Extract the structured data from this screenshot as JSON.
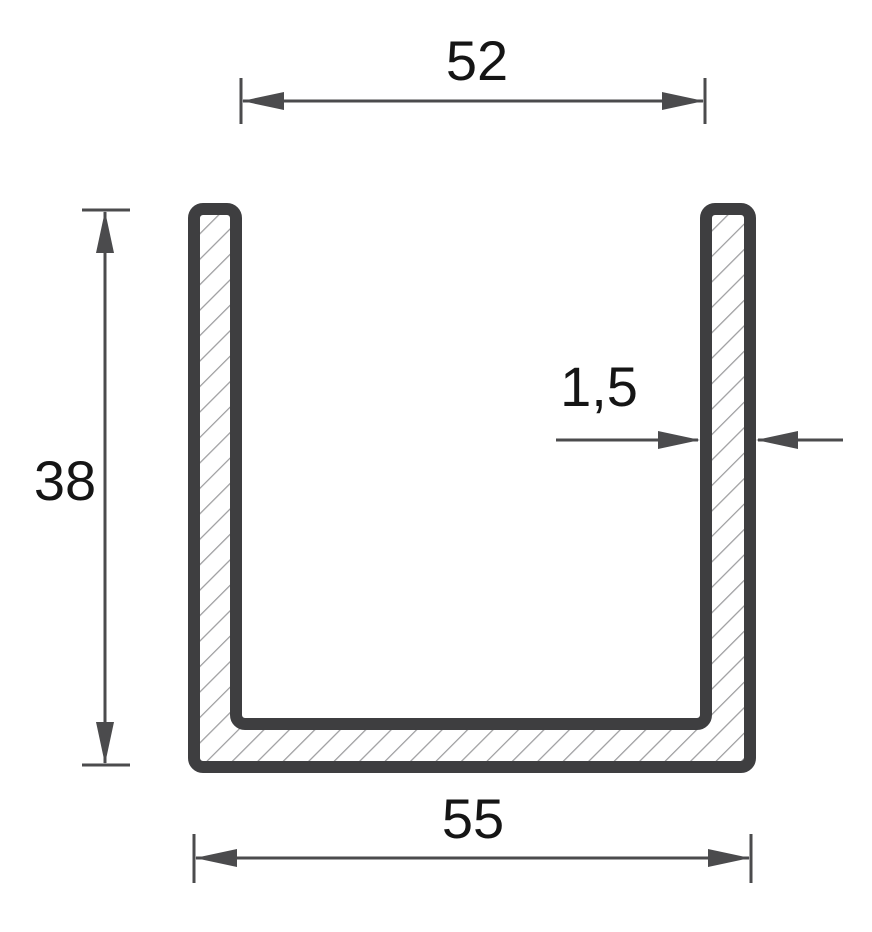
{
  "drawing": {
    "figure": "u-channel-profile-cross-section",
    "dimensions": {
      "inner_width": "52",
      "height": "38",
      "wall_thickness": "1,5",
      "outer_width": "55"
    },
    "colors": {
      "outline": "#3e3e40",
      "dimension": "#4b4b4d",
      "hatch": "#9d9d9f",
      "label": "#151515",
      "background": "#ffffff"
    }
  }
}
